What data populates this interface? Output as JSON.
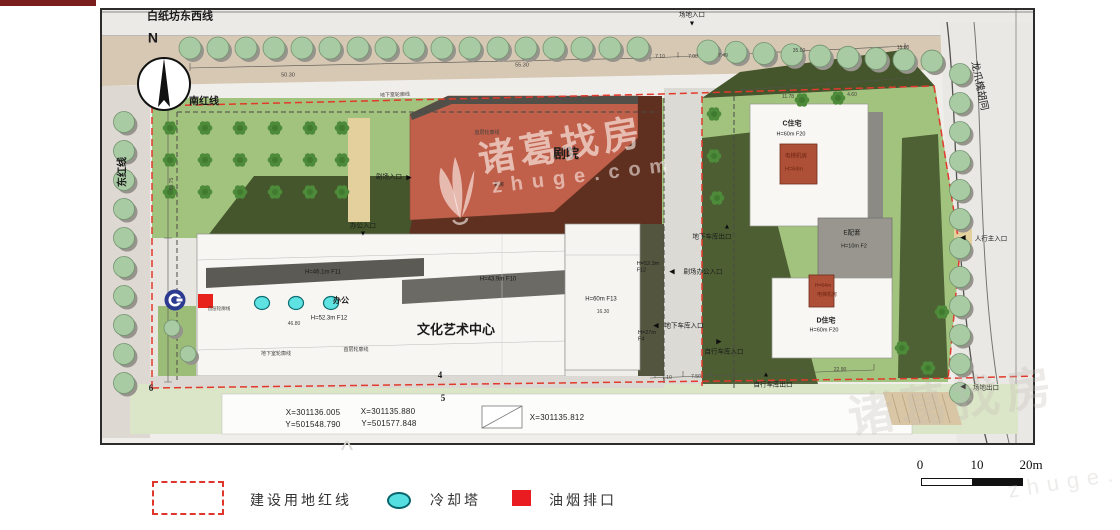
{
  "watermark": {
    "brand": "诸葛找房",
    "domain": "zhuge.com"
  },
  "legend": {
    "items": [
      {
        "label": "建设用地红线",
        "swatch": "red-dashed-rect"
      },
      {
        "label": "冷却塔",
        "swatch": "cyan-ellipse"
      },
      {
        "label": "油烟排口",
        "swatch": "red-square"
      }
    ]
  },
  "scale_bar": {
    "labels": [
      "0",
      "10",
      "20m"
    ]
  },
  "colors": {
    "redline": "#de372b",
    "cooling_tower": "#55dfe1",
    "oil_outlet": "#e91c22",
    "theater_roof": "#c05f4a",
    "lawn": "#a2c37e"
  },
  "annotations": [
    {
      "name": "street-top-label",
      "text": "白纸坊东西线",
      "x": 180,
      "y": 17,
      "fs": 11,
      "bold": true
    },
    {
      "name": "red-line-south-label",
      "text": "南红线",
      "x": 204,
      "y": 102,
      "fs": 10,
      "bold": true
    },
    {
      "name": "red-line-east-label",
      "text": "东红线",
      "x": 123,
      "y": 172,
      "fs": 10,
      "rot": -90,
      "bold": true
    },
    {
      "name": "street-right-label",
      "text": "龙爪槐胡同",
      "x": 979,
      "y": 86,
      "fs": 10,
      "rot": 78
    },
    {
      "name": "north-label",
      "text": "N",
      "x": 153,
      "y": 39,
      "fs": 14,
      "bold": true
    },
    {
      "name": "theater-label",
      "text": "剧院",
      "x": 566,
      "y": 155,
      "fs": 13,
      "bold": true
    },
    {
      "name": "art-center-label",
      "text": "文化艺术中心",
      "x": 456,
      "y": 331,
      "fs": 13,
      "bold": true
    },
    {
      "name": "f11-height-label",
      "text": "H=46.1m F11",
      "x": 323,
      "y": 272,
      "fs": 6
    },
    {
      "name": "office-label",
      "text": "办公",
      "x": 341,
      "y": 301,
      "fs": 8,
      "bold": true
    },
    {
      "name": "f12-height-label",
      "text": "H=52.3m F12",
      "x": 329,
      "y": 318,
      "fs": 6
    },
    {
      "name": "f10-height-label",
      "text": "H=43.9m F10",
      "x": 498,
      "y": 279,
      "fs": 6
    },
    {
      "name": "f13-height-label",
      "text": "H=60m F13",
      "x": 601,
      "y": 299,
      "fs": 6
    },
    {
      "name": "dim-16-30",
      "text": "16.30",
      "x": 603,
      "y": 312,
      "fs": 5,
      "cls": "dim"
    },
    {
      "name": "c-residence-label",
      "text": "C住宅",
      "x": 792,
      "y": 124,
      "fs": 7,
      "bold": true
    },
    {
      "name": "c-residence-height",
      "text": "H=60m F20",
      "x": 791,
      "y": 134,
      "fs": 5.5
    },
    {
      "name": "c-elevator-label",
      "text": "电梯机房",
      "x": 796,
      "y": 156,
      "fs": 5.5,
      "cls": "red"
    },
    {
      "name": "c-elevator-height",
      "text": "H=64m",
      "x": 794,
      "y": 169,
      "fs": 5.5,
      "cls": "red"
    },
    {
      "name": "e-annex-label",
      "text": "E配套",
      "x": 852,
      "y": 233,
      "fs": 6.5
    },
    {
      "name": "e-annex-height",
      "text": "H=10m F2",
      "x": 854,
      "y": 246,
      "fs": 5.5
    },
    {
      "name": "d-elevator-height",
      "text": "H=64m",
      "x": 823,
      "y": 286,
      "fs": 5,
      "cls": "red"
    },
    {
      "name": "d-elevator-label",
      "text": "电梯机房",
      "x": 827,
      "y": 295,
      "fs": 5,
      "cls": "red"
    },
    {
      "name": "d-residence-label",
      "text": "D住宅",
      "x": 826,
      "y": 321,
      "fs": 7,
      "bold": true
    },
    {
      "name": "d-residence-height",
      "text": "H=60m F20",
      "x": 824,
      "y": 330,
      "fs": 5.5
    },
    {
      "name": "f12-side-label",
      "text": "H=52.3m\nF12",
      "x": 648,
      "y": 267,
      "fs": 5.5
    },
    {
      "name": "f4-side-label",
      "text": "H=27m\nF4",
      "x": 647,
      "y": 336,
      "fs": 5.5
    },
    {
      "name": "site-entrance-label",
      "text": "场地入口",
      "x": 692,
      "y": 15,
      "fs": 6.5
    },
    {
      "name": "site-entrance-arrow",
      "text": "▼",
      "x": 692,
      "y": 24,
      "fs": 7,
      "cls": "arrow"
    },
    {
      "name": "theater-entrance-label",
      "text": "剧场入口",
      "x": 389,
      "y": 177,
      "fs": 6.5
    },
    {
      "name": "theater-entrance-arrow",
      "text": "▶",
      "x": 409,
      "y": 178,
      "fs": 7,
      "cls": "arrow"
    },
    {
      "name": "office-entrance-label",
      "text": "办公入口",
      "x": 363,
      "y": 226,
      "fs": 6.5
    },
    {
      "name": "office-entrance-arrow",
      "text": "▼",
      "x": 363,
      "y": 234,
      "fs": 7,
      "cls": "arrow"
    },
    {
      "name": "garage-exit-label",
      "text": "地下车库出口",
      "x": 712,
      "y": 237,
      "fs": 6.5
    },
    {
      "name": "garage-exit-arrow",
      "text": "▲",
      "x": 727,
      "y": 227,
      "fs": 7,
      "cls": "arrow"
    },
    {
      "name": "theater-office-entrance-label",
      "text": "剧场办公入口",
      "x": 703,
      "y": 272,
      "fs": 6.5
    },
    {
      "name": "theater-office-entrance-arrow",
      "text": "◀",
      "x": 672,
      "y": 272,
      "fs": 7,
      "cls": "arrow"
    },
    {
      "name": "garage-entrance-label",
      "text": "地下车库入口",
      "x": 684,
      "y": 326,
      "fs": 6.5
    },
    {
      "name": "garage-entrance-arrow",
      "text": "◀",
      "x": 656,
      "y": 326,
      "fs": 7,
      "cls": "arrow"
    },
    {
      "name": "bike-entrance-label",
      "text": "自行车库入口",
      "x": 724,
      "y": 352,
      "fs": 6.5
    },
    {
      "name": "bike-entrance-arrow",
      "text": "▶",
      "x": 719,
      "y": 342,
      "fs": 7,
      "cls": "arrow"
    },
    {
      "name": "bike-exit-label",
      "text": "自行车库出口",
      "x": 773,
      "y": 385,
      "fs": 6.5
    },
    {
      "name": "bike-exit-arrow",
      "text": "▲",
      "x": 766,
      "y": 375,
      "fs": 7,
      "cls": "arrow"
    },
    {
      "name": "pedestrian-entrance-label",
      "text": "人行主入口",
      "x": 991,
      "y": 239,
      "fs": 6.5
    },
    {
      "name": "pedestrian-entrance-arrow",
      "text": "◀",
      "x": 963,
      "y": 238,
      "fs": 7,
      "cls": "arrow"
    },
    {
      "name": "site-exit-label",
      "text": "场地出口",
      "x": 986,
      "y": 388,
      "fs": 6.5
    },
    {
      "name": "site-exit-arrow",
      "text": "◀",
      "x": 963,
      "y": 387,
      "fs": 7,
      "cls": "arrow"
    },
    {
      "name": "dim-50-30",
      "text": "50.30",
      "x": 288,
      "y": 75,
      "fs": 5.5,
      "cls": "dim"
    },
    {
      "name": "dim-55-30",
      "text": "55.30",
      "x": 522,
      "y": 65,
      "fs": 5.5,
      "cls": "dim"
    },
    {
      "name": "dim-7-10-top",
      "text": "7.10",
      "x": 660,
      "y": 57,
      "fs": 5,
      "cls": "dim"
    },
    {
      "name": "dim-7-00",
      "text": "7.00",
      "x": 693,
      "y": 57,
      "fs": 5,
      "cls": "dim"
    },
    {
      "name": "dim-7-49",
      "text": "7.49",
      "x": 723,
      "y": 56,
      "fs": 5,
      "cls": "dim"
    },
    {
      "name": "dim-35-00",
      "text": "35.00",
      "x": 799,
      "y": 51,
      "fs": 5,
      "cls": "dim"
    },
    {
      "name": "dim-15-00",
      "text": "15.00",
      "x": 903,
      "y": 48,
      "fs": 5,
      "cls": "dim"
    },
    {
      "name": "dim-11-78",
      "text": "11.78",
      "x": 788,
      "y": 97,
      "fs": 5,
      "cls": "dim"
    },
    {
      "name": "dim-4-60",
      "text": "4.60",
      "x": 852,
      "y": 95,
      "fs": 5,
      "cls": "dim"
    },
    {
      "name": "dim-46-80",
      "text": "46.80",
      "x": 294,
      "y": 324,
      "fs": 5,
      "cls": "dim"
    },
    {
      "name": "dim-7-10-bottom",
      "text": "7.10",
      "x": 667,
      "y": 378,
      "fs": 5,
      "cls": "dim"
    },
    {
      "name": "dim-7-50",
      "text": "7.50",
      "x": 696,
      "y": 377,
      "fs": 5,
      "cls": "dim"
    },
    {
      "name": "dim-22-90",
      "text": "22.90",
      "x": 840,
      "y": 370,
      "fs": 5,
      "cls": "dim"
    },
    {
      "name": "dim-60-75",
      "text": "60.75",
      "x": 172,
      "y": 184,
      "fs": 5,
      "rot": -90,
      "cls": "dim"
    },
    {
      "name": "outline-basement-1",
      "text": "地下室轮廓线",
      "x": 395,
      "y": 95,
      "fs": 5,
      "rot": -2,
      "cls": "dim"
    },
    {
      "name": "outline-first-floor-1",
      "text": "首层轮廓线",
      "x": 487,
      "y": 133,
      "fs": 5,
      "cls": "dim"
    },
    {
      "name": "machine-room-label",
      "text": "机房",
      "x": 499,
      "y": 185,
      "fs": 5
    },
    {
      "name": "outline-first-floor-2",
      "text": "首层轮廓线",
      "x": 219,
      "y": 309,
      "fs": 4.5,
      "cls": "dim"
    },
    {
      "name": "outline-basement-2",
      "text": "地下室轮廓线",
      "x": 276,
      "y": 354,
      "fs": 5,
      "cls": "dim"
    },
    {
      "name": "outline-first-floor-3",
      "text": "首层轮廓线",
      "x": 356,
      "y": 350,
      "fs": 5,
      "cls": "dim"
    },
    {
      "name": "coord-x1",
      "text": "X=301136.005",
      "x": 313,
      "y": 413,
      "fs": 8,
      "cls": "coord"
    },
    {
      "name": "coord-y1",
      "text": "Y=501548.790",
      "x": 313,
      "y": 425,
      "fs": 8,
      "cls": "coord"
    },
    {
      "name": "coord-x2",
      "text": "X=301135.880",
      "x": 388,
      "y": 412,
      "fs": 8,
      "cls": "coord"
    },
    {
      "name": "coord-y2",
      "text": "Y=501577.848",
      "x": 389,
      "y": 424,
      "fs": 8,
      "cls": "coord"
    },
    {
      "name": "coord-x3",
      "text": "X=301135.812",
      "x": 557,
      "y": 418,
      "fs": 8,
      "cls": "coord"
    },
    {
      "name": "boundary-number-4",
      "text": "4",
      "x": 440,
      "y": 376,
      "fs": 9,
      "cls": "num"
    },
    {
      "name": "boundary-number-5",
      "text": "5",
      "x": 443,
      "y": 399,
      "fs": 9,
      "cls": "num"
    },
    {
      "name": "boundary-number-6",
      "text": "6",
      "x": 151,
      "y": 389,
      "fs": 9,
      "cls": "num"
    },
    {
      "name": "faint-caption-mark",
      "text": "^",
      "x": 347,
      "y": 452,
      "fs": 26,
      "cls": "faint"
    }
  ]
}
